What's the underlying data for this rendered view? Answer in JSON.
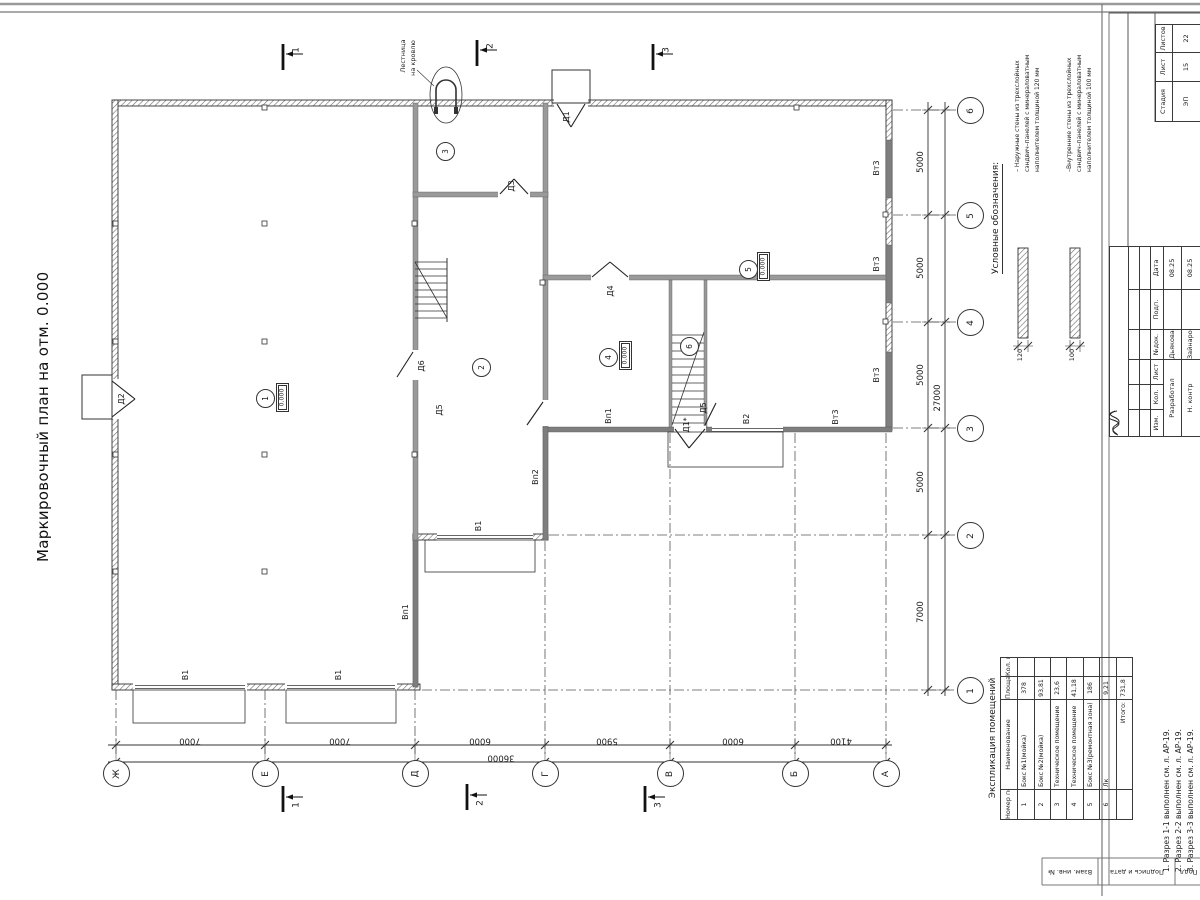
{
  "sheet_title": "Маркировочный план на отм. 0.000",
  "legend": {
    "heading": "Условные обозначения:",
    "items": [
      {
        "name": "exterior-wall-legend",
        "lines": [
          "– Наружные стены из трехслойных",
          "сэндвич–панелей с минераловатным",
          "наполнителем толщиной 120 мм"
        ],
        "dim": "120"
      },
      {
        "name": "interior-wall-legend",
        "lines": [
          "–Внутренние стены из трехслойных",
          "сэндвич–панелей с минераловатным",
          "наполнителем толщиной 100 мм"
        ],
        "dim": "100"
      }
    ]
  },
  "explication": {
    "heading": "Экспликация помещений",
    "columns": [
      "Номер помещ.",
      "Наименование",
      "Площадь, м2",
      "Кол. пом."
    ],
    "rows": [
      {
        "num": "1",
        "label": "Бокс №1(мойка)",
        "area": "378",
        "count": ""
      },
      {
        "num": "2",
        "label": "Бокс №2(мойка)",
        "area": "93,81",
        "count": ""
      },
      {
        "num": "3",
        "label": "Техническое помещение",
        "area": "23,6",
        "count": ""
      },
      {
        "num": "4",
        "label": "Техническое помещение",
        "area": "41,18",
        "count": ""
      },
      {
        "num": "5",
        "label": "Бокс №3(ремонтная зона)",
        "area": "186",
        "count": ""
      },
      {
        "num": "6",
        "label": "Лк",
        "area": "9,21",
        "count": ""
      }
    ],
    "total_label": "Итого:",
    "total_area": "731,8"
  },
  "elevation_value": "0.000",
  "rooms": [
    {
      "num": "1",
      "cx": 264,
      "cy": 397,
      "elev": true,
      "ex": 276,
      "ey": 383
    },
    {
      "num": "2",
      "cx": 480,
      "cy": 366
    },
    {
      "num": "3",
      "cx": 444,
      "cy": 150
    },
    {
      "num": "4",
      "cx": 607,
      "cy": 356,
      "elev": true,
      "ex": 619,
      "ey": 341
    },
    {
      "num": "5",
      "cx": 747,
      "cy": 268,
      "elev": true,
      "ex": 757,
      "ey": 252
    },
    {
      "num": "6",
      "cx": 688,
      "cy": 345
    }
  ],
  "axes": {
    "bottom": [
      {
        "label": "Ж",
        "x": 116
      },
      {
        "label": "Е",
        "x": 265
      },
      {
        "label": "Д",
        "x": 415
      },
      {
        "label": "Г",
        "x": 545
      },
      {
        "label": "В",
        "x": 670
      },
      {
        "label": "Б",
        "x": 795
      },
      {
        "label": "А",
        "x": 886
      }
    ],
    "right": [
      {
        "label": "6",
        "y": 110
      },
      {
        "label": "5",
        "y": 215
      },
      {
        "label": "4",
        "y": 322
      },
      {
        "label": "3",
        "y": 428
      },
      {
        "label": "2",
        "y": 535
      },
      {
        "label": "1",
        "y": 690
      }
    ]
  },
  "dimensions": {
    "bottom": [
      {
        "value": "7000",
        "x": 190
      },
      {
        "value": "7000",
        "x": 340
      },
      {
        "value": "6000",
        "x": 480
      },
      {
        "value": "5900",
        "x": 607
      },
      {
        "value": "6000",
        "x": 733
      },
      {
        "value": "4100",
        "x": 841
      }
    ],
    "bottom_total": {
      "value": "36000",
      "x": 501
    },
    "right": [
      {
        "value": "5000",
        "y": 162
      },
      {
        "value": "5000",
        "y": 268
      },
      {
        "value": "5000",
        "y": 375
      },
      {
        "value": "5000",
        "y": 482
      },
      {
        "value": "7000",
        "y": 612
      }
    ],
    "right_total": {
      "value": "27000",
      "y": 398
    }
  },
  "annotations": [
    {
      "name": "label-door-d1",
      "text": "Д1",
      "x": 567,
      "y": 117
    },
    {
      "name": "label-door-d2",
      "text": "Д2",
      "x": 122,
      "y": 399
    },
    {
      "name": "label-door-d3",
      "text": "Д3",
      "x": 512,
      "y": 186
    },
    {
      "name": "label-door-d4",
      "text": "Д4",
      "x": 611,
      "y": 291
    },
    {
      "name": "label-door-d5-a",
      "text": "Д5",
      "x": 440,
      "y": 410
    },
    {
      "name": "label-door-d5-b",
      "text": "Д5",
      "x": 704,
      "y": 408
    },
    {
      "name": "label-door-d1-star",
      "text": "Д1*",
      "x": 687,
      "y": 425
    },
    {
      "name": "label-door-d6",
      "text": "Д6",
      "x": 422,
      "y": 366
    },
    {
      "name": "label-gate-v1-a",
      "text": "В1",
      "x": 186,
      "y": 675
    },
    {
      "name": "label-gate-v1-b",
      "text": "В1",
      "x": 339,
      "y": 675
    },
    {
      "name": "label-gate-v1-c",
      "text": "В1",
      "x": 479,
      "y": 526
    },
    {
      "name": "label-gate-v2",
      "text": "В2",
      "x": 747,
      "y": 419
    },
    {
      "name": "label-vent-vp1-a",
      "text": "Вп1",
      "x": 406,
      "y": 612
    },
    {
      "name": "label-vent-vp1-b",
      "text": "Вп1",
      "x": 609,
      "y": 416
    },
    {
      "name": "label-vent-vp2",
      "text": "Вп2",
      "x": 536,
      "y": 477
    },
    {
      "name": "label-vent-vt3-a",
      "text": "Вт3",
      "x": 877,
      "y": 168
    },
    {
      "name": "label-vent-vt3-b",
      "text": "Вт3",
      "x": 877,
      "y": 264
    },
    {
      "name": "label-vent-vt3-c",
      "text": "Вт3",
      "x": 877,
      "y": 375
    },
    {
      "name": "label-vent-vt3-d",
      "text": "Вт3",
      "x": 836,
      "y": 417
    },
    {
      "name": "label-section-1-top",
      "text": "1",
      "x": 297,
      "y": 50,
      "fs": 9
    },
    {
      "name": "label-section-2-top",
      "text": "2",
      "x": 491,
      "y": 46,
      "fs": 9
    },
    {
      "name": "label-section-3-top",
      "text": "3",
      "x": 667,
      "y": 50,
      "fs": 9
    },
    {
      "name": "label-section-1-bottom",
      "text": "1",
      "x": 297,
      "y": 805,
      "fs": 9
    },
    {
      "name": "label-section-2-bottom",
      "text": "2",
      "x": 481,
      "y": 803,
      "fs": 9
    },
    {
      "name": "label-section-3-bottom",
      "text": "3",
      "x": 659,
      "y": 805,
      "fs": 9
    },
    {
      "name": "label-ladder-line1",
      "text": "Лестница",
      "x": 403,
      "y": 56,
      "fs": 6.5
    },
    {
      "name": "label-ladder-line2",
      "text": "на кровлю",
      "x": 413,
      "y": 58,
      "fs": 6.5
    },
    {
      "name": "label-legend-dim-120",
      "text": "120",
      "x": 1020,
      "y": 355,
      "fs": 6.5
    },
    {
      "name": "label-legend-dim-100",
      "text": "100",
      "x": 1072,
      "y": 355,
      "fs": 6.5
    }
  ],
  "title_block": {
    "stadia": {
      "labels": [
        "Стадия",
        "Лист",
        "Листов"
      ],
      "values": [
        "ЭП",
        "15",
        "22"
      ]
    },
    "columns": [
      "Изм.",
      "Кол.",
      "Лист",
      "№док.",
      "Подп.",
      "Дата"
    ],
    "rows": [
      {
        "role": "Разработал",
        "name": "Дьякова",
        "date": "08.25"
      },
      {
        "role": "Н. контр",
        "name": "Зайнарова",
        "date": "08.25"
      }
    ]
  },
  "side_strip": [
    "Взам. инв. №",
    "Подпись и дата",
    "Подл."
  ],
  "notes": [
    "1. Разрез 1-1 выполнен см. л. АР-19.",
    "2. Разрез 2-2 выполнен см. л. АР-19.",
    "3. Разрез 3-3 выполнен см. л. АР-19."
  ]
}
